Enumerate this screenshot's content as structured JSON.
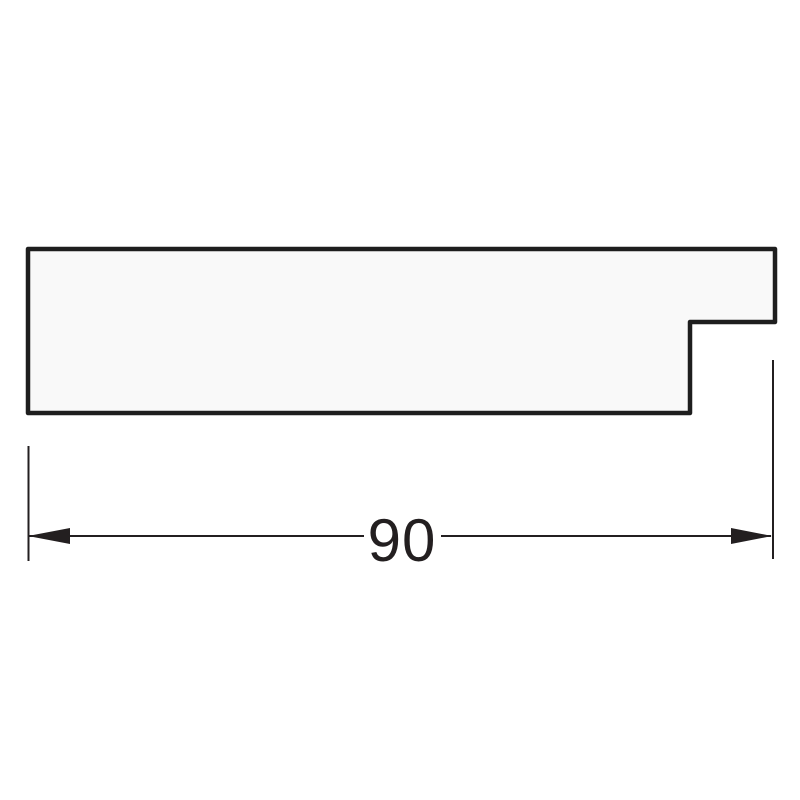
{
  "drawing": {
    "description": "Technical cross-section drawing of a stepped moulding profile with one horizontal width dimension",
    "profile": {
      "path": "M 28 249 L 775 249 L 775 322 L 690 322 L 690 413 L 28 413 Z",
      "corner_style": "slightly rounded"
    },
    "dimension": {
      "label": "90",
      "orientation": "horizontal",
      "measures": "overall width of profile",
      "arrow_style": "solid filled triangles pointing outward"
    }
  },
  "colors": {
    "background": "#ffffff",
    "profile_fill": "#f9f9f9",
    "profile_outline": "#1e1e1e",
    "dimension_ink": "#231f20"
  }
}
